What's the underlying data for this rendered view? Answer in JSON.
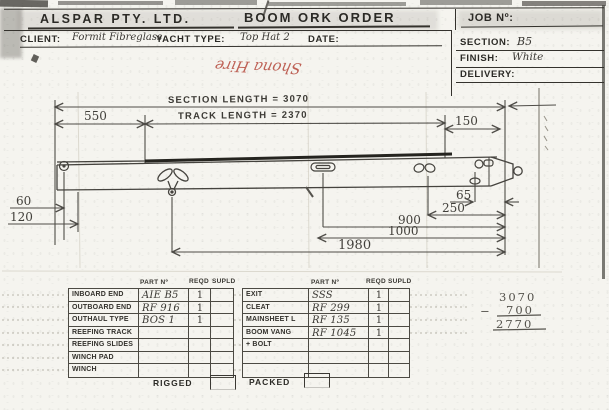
{
  "form": {
    "company": "ALSPAR PTY. LTD.",
    "title": "BOOM ORK ORDER",
    "job_no_label": "JOB Nº:",
    "client_label": "CLIENT:",
    "client_value": "Formit Fibreglass",
    "yacht_type_label": "YACHT TYPE:",
    "yacht_type_value": "Top Hat 2",
    "date_label": "DATE:",
    "section_label": "SECTION:",
    "section_value": "B5",
    "finish_label": "FINISH:",
    "finish_value": "White",
    "delivery_label": "DELIVERY:",
    "red_note": "Shona Hire"
  },
  "drawing": {
    "section_length_label": "SECTION LENGTH = 3070",
    "track_length_label": "TRACK LENGTH = 2370",
    "dim_550": "550",
    "dim_150": "150",
    "dim_60": "60",
    "dim_120": "120",
    "dim_65": "65",
    "dim_250": "250",
    "dim_900": "900",
    "dim_1000": "1000",
    "dim_1980": "1980"
  },
  "parts": {
    "col_part_no": "PART Nº",
    "col_reqd": "REQD",
    "col_supld": "SUPLD",
    "left": [
      {
        "label": "INBOARD END",
        "part": "AIE B5",
        "reqd": "1",
        "supld": ""
      },
      {
        "label": "OUTBOARD END",
        "part": "RF 916",
        "reqd": "1",
        "supld": ""
      },
      {
        "label": "OUTHAUL TYPE",
        "part": "BOS 1",
        "reqd": "1",
        "supld": ""
      },
      {
        "label": "REEFING TRACK",
        "part": "",
        "reqd": "",
        "supld": ""
      },
      {
        "label": "REEFING SLIDES",
        "part": "",
        "reqd": "",
        "supld": ""
      },
      {
        "label": "WINCH PAD",
        "part": "",
        "reqd": "",
        "supld": ""
      },
      {
        "label": "WINCH",
        "part": "",
        "reqd": "",
        "supld": ""
      }
    ],
    "right": [
      {
        "label": "EXIT",
        "part": "SSS",
        "reqd": "1",
        "supld": ""
      },
      {
        "label": "CLEAT",
        "part": "RF 299",
        "reqd": "1",
        "supld": ""
      },
      {
        "label": "MAINSHEET L",
        "part": "RF 135",
        "reqd": "1",
        "supld": ""
      },
      {
        "label": "BOOM VANG",
        "part": "RF 1045",
        "reqd": "1",
        "supld": ""
      },
      {
        "label": "+ BOLT",
        "part": "",
        "reqd": "",
        "supld": ""
      },
      {
        "label": "",
        "part": "",
        "reqd": "",
        "supld": ""
      },
      {
        "label": "",
        "part": "",
        "reqd": "",
        "supld": ""
      }
    ]
  },
  "calc": {
    "minuend": "3070",
    "minus_sign": "−",
    "subtrahend": "700",
    "result": "2770"
  },
  "footer": {
    "rigged": "RIGGED",
    "packed": "PACKED"
  }
}
